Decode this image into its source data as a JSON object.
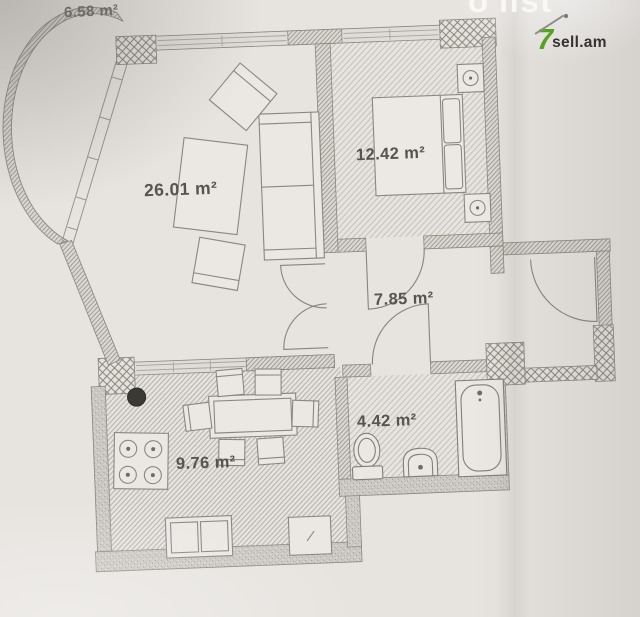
{
  "branding": {
    "watermark": "ō'list",
    "logo_prefix": "7",
    "logo_suffix": "sell.am"
  },
  "rooms": {
    "balcony": {
      "area_label": "6.58 m²"
    },
    "living": {
      "area_label": "26.01 m²"
    },
    "bedroom": {
      "area_label": "12.42 m²"
    },
    "hall": {
      "area_label": "7.85 m²"
    },
    "bathroom": {
      "area_label": "4.42 m²"
    },
    "kitchen": {
      "area_label": "9.76 m²"
    }
  },
  "colors": {
    "paper": "#e7e4e0",
    "wall_line": "#8a8783",
    "label_text": "#57534e",
    "logo_green": "#57a31f",
    "logo_text": "#35332f",
    "watermark_white": "#faf9f6",
    "column_black": "#3b3936"
  }
}
